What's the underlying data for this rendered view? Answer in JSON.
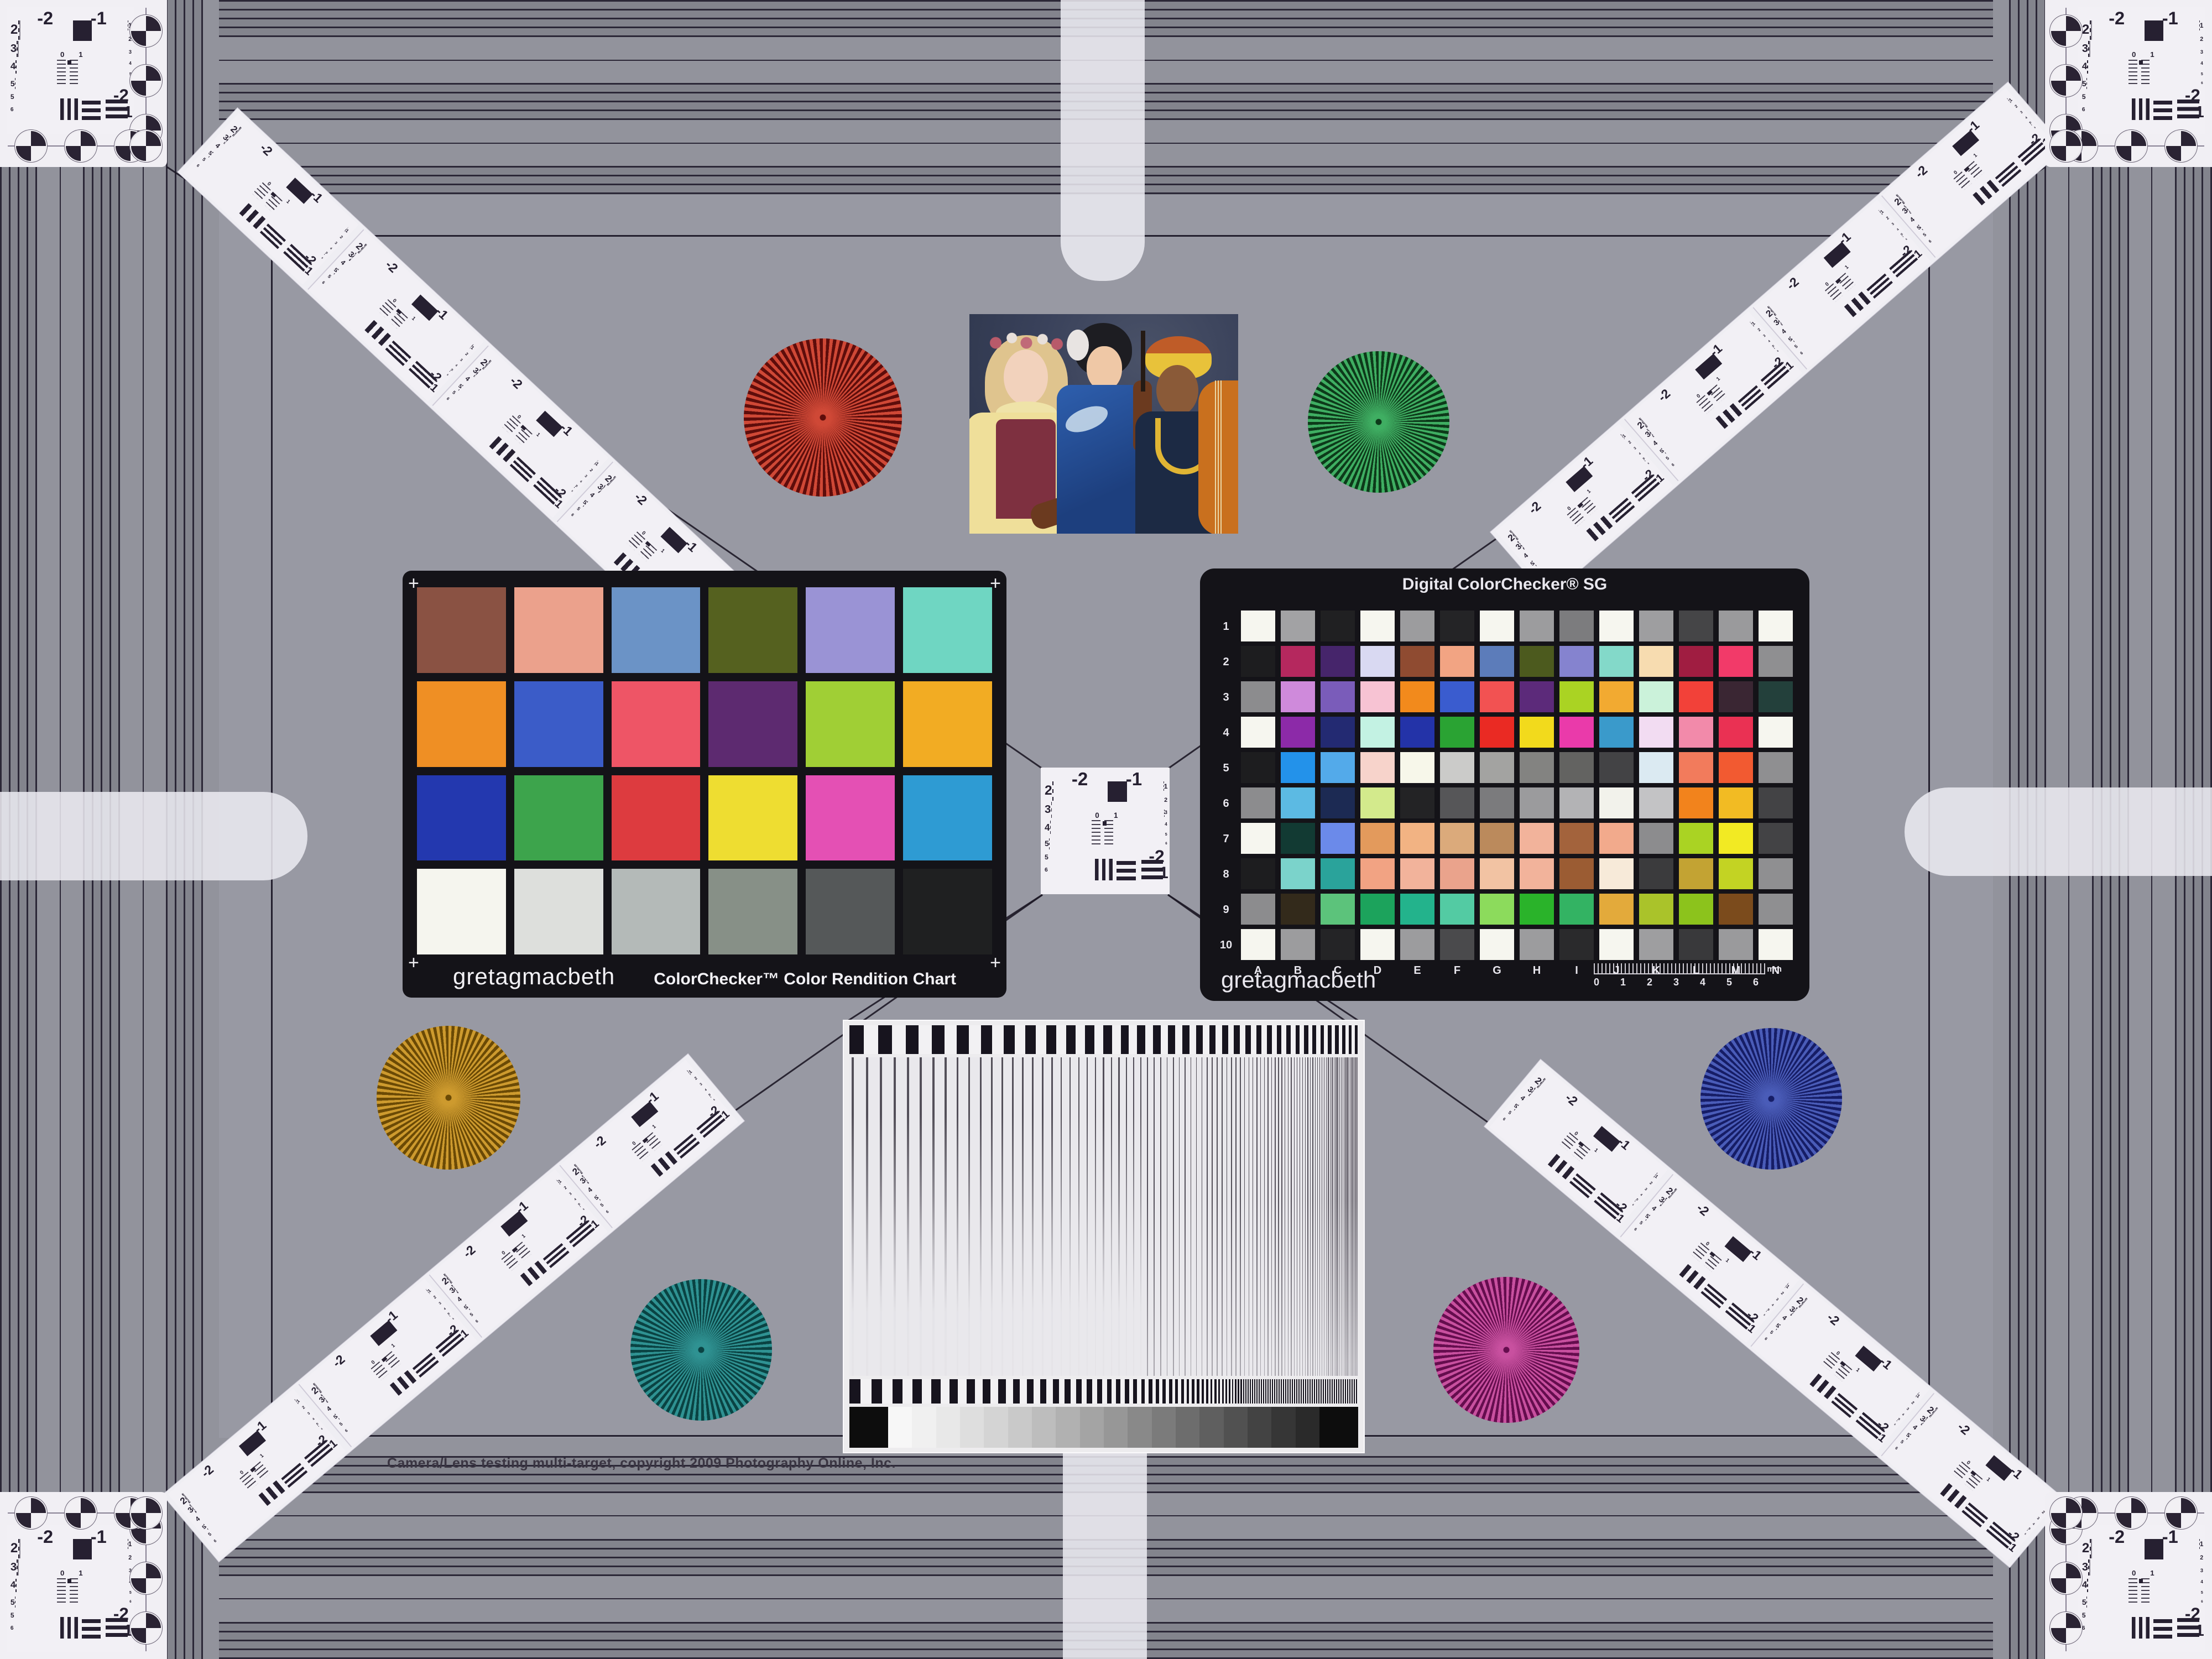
{
  "footer": {
    "copyright": "Camera/Lens testing multi-target, copyright 2009 Photography Online, Inc."
  },
  "classic": {
    "brand": "gretagmacbeth",
    "title": "ColorChecker™ Color Rendition Chart",
    "reg_mark": "+",
    "patches": [
      "#8a5243",
      "#eba18c",
      "#6b93c6",
      "#55611f",
      "#9a93d5",
      "#6fd6c2",
      "#ef8f24",
      "#3b5cc8",
      "#ee5566",
      "#5d2a70",
      "#a0cf35",
      "#f2ac23",
      "#2338af",
      "#3da44c",
      "#dd3b3f",
      "#eedd31",
      "#e450b4",
      "#2e9bd3",
      "#f5f5ee",
      "#dddfdc",
      "#b4bab8",
      "#879087",
      "#555859",
      "#1f2021"
    ]
  },
  "sg": {
    "title": "Digital ColorChecker® SG",
    "brand": "gretagmacbeth",
    "row_labels": [
      "1",
      "2",
      "3",
      "4",
      "5",
      "6",
      "7",
      "8",
      "9",
      "10"
    ],
    "col_labels": [
      "A",
      "B",
      "C",
      "D",
      "E",
      "F",
      "G",
      "H",
      "I",
      "J",
      "K",
      "L",
      "M",
      "N"
    ],
    "ruler_numbers": [
      "0",
      "1",
      "2",
      "3",
      "4",
      "5",
      "6"
    ],
    "ruler_unit": "mm",
    "patches": [
      [
        "#f6f6ef",
        "#a2a2a4",
        "#202022",
        "#f6f6ef",
        "#9c9c9e",
        "#242426",
        "#f6f6ef",
        "#9c9c9e",
        "#7c7c7e",
        "#f6f6ef",
        "#9e9ea0",
        "#454547",
        "#9a9a9c",
        "#f6f6ef"
      ],
      [
        "#1d1d1f",
        "#b5285e",
        "#46256b",
        "#d9d9f2",
        "#8f4b31",
        "#f2a483",
        "#5c7cba",
        "#4c5a1e",
        "#8583cf",
        "#83d9c9",
        "#f7dcb0",
        "#a01d41",
        "#f23a69",
        "#8f8f91"
      ],
      [
        "#8c8c8e",
        "#cf8adb",
        "#7a5cba",
        "#f7c3d3",
        "#f28a1c",
        "#3a5ccf",
        "#f25252",
        "#5c2a7a",
        "#aad323",
        "#f2aa31",
        "#cbf2da",
        "#f24139",
        "#3a2633",
        "#23403b"
      ],
      [
        "#f6f6ef",
        "#8c2aa8",
        "#232a72",
        "#c3f2e3",
        "#2333a8",
        "#2aa333",
        "#ea2a23",
        "#f2da1c",
        "#ea3aaa",
        "#3a9acb",
        "#f2dcf2",
        "#f28aaa",
        "#ea3153",
        "#f6f6ef"
      ],
      [
        "#1d1d1f",
        "#2392ea",
        "#53aaea",
        "#f7d3cb",
        "#f7f7ea",
        "#cbcbc9",
        "#a3a3a1",
        "#838381",
        "#636361",
        "#434345",
        "#dbeaf2",
        "#f27b5c",
        "#f25a31",
        "#8f8f91"
      ],
      [
        "#8c8c8e",
        "#5cbae3",
        "#1c2a53",
        "#d3ea8c",
        "#232325",
        "#565658",
        "#7b7b7d",
        "#9b9b9d",
        "#b3b3b5",
        "#f2f2eb",
        "#c3c3c5",
        "#f2831c",
        "#f2bb23",
        "#434345"
      ],
      [
        "#f6f6ef",
        "#123a33",
        "#6b8aea",
        "#e39a5c",
        "#f2b383",
        "#dbaa7b",
        "#bb8a5c",
        "#f2b39b",
        "#a3633c",
        "#f2aa8c",
        "#8c8c8e",
        "#aad323",
        "#f2ea23",
        "#434345"
      ],
      [
        "#1d1d1f",
        "#7bd3cb",
        "#2aa39b",
        "#f2a383",
        "#f2b39b",
        "#eaa38c",
        "#f2c3a3",
        "#f2b39b",
        "#9b5c33",
        "#f7ead9",
        "#3b3b3d",
        "#c3a333",
        "#c3d323",
        "#8f8f91"
      ],
      [
        "#8c8c8e",
        "#332a1b",
        "#5cc37b",
        "#1ca35c",
        "#23b38c",
        "#53cba3",
        "#8cdb5c",
        "#2ab32a",
        "#33b363",
        "#e3aa3b",
        "#aac32a",
        "#8cc31c",
        "#7b4b1c",
        "#8f8f91"
      ],
      [
        "#f6f6ef",
        "#9c9c9e",
        "#242426",
        "#f6f6ef",
        "#9c9c9e",
        "#4a4a4c",
        "#f6f6ef",
        "#9c9c9e",
        "#2a2a2c",
        "#f6f6ef",
        "#9e9ea0",
        "#39393b",
        "#9a9a9c",
        "#f6f6ef"
      ]
    ]
  },
  "usaf": {
    "header_left": "-2",
    "header_right": "-1",
    "left_numbers": [
      "2",
      "3",
      "4",
      "5"
    ],
    "extra_numbers": [
      "5",
      "6"
    ],
    "right_numbers": [
      "1",
      "2",
      "3",
      "4",
      "5",
      "6"
    ],
    "bottom_left_label": "-2",
    "bottom_right_label": "1",
    "center_zero": "0",
    "center_one": "1"
  },
  "stars": [
    {
      "name": "red",
      "light": "#cf4836",
      "dark": "#5e0d0b"
    },
    {
      "name": "green",
      "light": "#3fae62",
      "dark": "#0d3a1a"
    },
    {
      "name": "gold",
      "light": "#cd9a2e",
      "dark": "#6b4a05"
    },
    {
      "name": "blue",
      "light": "#4a5cb8",
      "dark": "#161d66"
    },
    {
      "name": "teal",
      "light": "#2f9292",
      "dark": "#0a4343"
    },
    {
      "name": "magenta",
      "light": "#c8509f",
      "dark": "#650d4e"
    }
  ],
  "sweep": {
    "end_color": "#0d0d0d",
    "wedge": [
      "#f7f7f7",
      "#f0f0f0",
      "#e8e8e8",
      "#dedede",
      "#d4d4d4",
      "#c9c9c9",
      "#bdbdbd",
      "#b1b1b1",
      "#a4a4a4",
      "#979797",
      "#898989",
      "#7b7b7b",
      "#6d6d6d",
      "#5f5f5f",
      "#515151",
      "#434343",
      "#363636",
      "#2a2a2a"
    ]
  },
  "palette": {
    "field_gray": "#9899a3",
    "band_gray": "#85868f",
    "stripe_line": "#2b2737",
    "card_white": "#f1eff4",
    "chart_black": "#141318",
    "frame_line": "#231f2e"
  }
}
